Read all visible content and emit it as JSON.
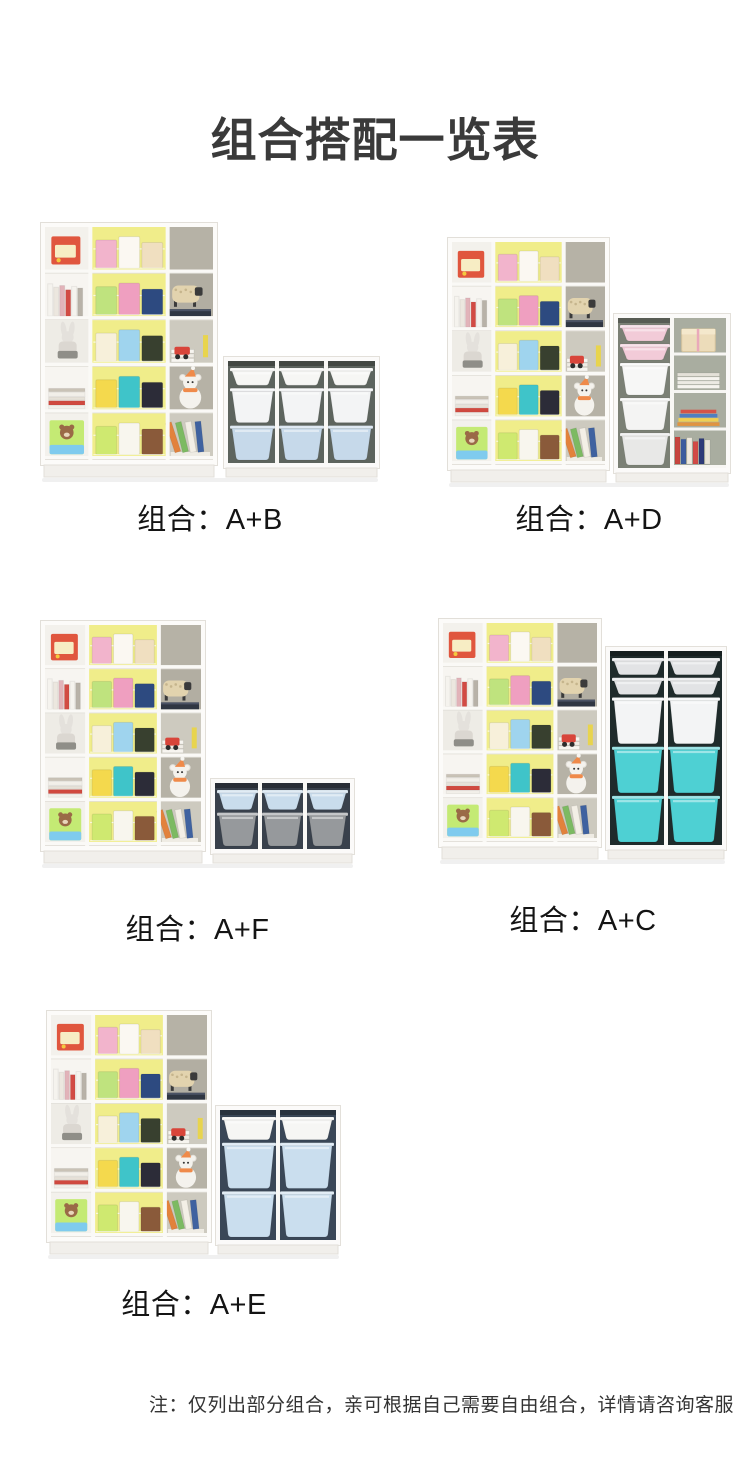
{
  "title": "组合搭配一览表",
  "footnote": "注：仅列出部分组合，亲可根据自己需要自由组合，详情请咨询客服",
  "shelf_a": {
    "frame_color": "#fcfbf9",
    "yellow_back": "#f0ed8a",
    "gray_back": "#b6b2a6"
  },
  "combos": [
    {
      "label": "组合：A+B",
      "illustration": {
        "svg_w": 340,
        "svg_h": 262,
        "shelf": {
          "w": 178,
          "h": 256
        },
        "unit": {
          "x": 183,
          "w": 157,
          "h": 122,
          "cols": 3,
          "interior": "#5d645e",
          "stack": [
            [
              "#f6f6f4",
              1
            ],
            [
              "#f3f4f5",
              2
            ],
            [
              "#c6d9ea",
              2
            ]
          ]
        }
      }
    },
    {
      "label": "组合：A+D",
      "illustration": {
        "svg_w": 284,
        "svg_h": 252,
        "shelf": {
          "w": 163,
          "h": 246
        },
        "unit": {
          "x": 166,
          "w": 118,
          "h": 170,
          "cols": 2,
          "interior": "#7b8075",
          "rightShelves": true,
          "stack": [
            [
              "#f2cbd8",
              1
            ],
            [
              "#f2cbd8",
              1
            ],
            [
              "#f7f7f6",
              2
            ],
            [
              "#f4f4f3",
              2
            ],
            [
              "#e8e8e7",
              2
            ]
          ]
        }
      }
    },
    {
      "label": "组合：A+F",
      "illustration": {
        "svg_w": 315,
        "svg_h": 250,
        "shelf": {
          "w": 166,
          "h": 244
        },
        "unit": {
          "x": 170,
          "w": 145,
          "h": 86,
          "cols": 3,
          "interior": "#39414c",
          "stack": [
            [
              "#c9dcec",
              1
            ],
            [
              "#96999c",
              1.7
            ]
          ]
        }
      }
    },
    {
      "label": "组合：A+C",
      "illustration": {
        "svg_w": 290,
        "svg_h": 248,
        "shelf": {
          "w": 164,
          "h": 242
        },
        "unit": {
          "x": 167,
          "w": 122,
          "h": 214,
          "cols": 2,
          "interior": "#1f2b2b",
          "stack": [
            [
              "#e2e3e5",
              0.8
            ],
            [
              "#e2e3e5",
              0.8
            ],
            [
              "#f3f4f5",
              2.2
            ],
            [
              "#4ed0d3",
              2.2
            ],
            [
              "#4ed0d3",
              2.2
            ]
          ]
        }
      }
    },
    {
      "label": "组合：A+E",
      "illustration": {
        "svg_w": 296,
        "svg_h": 251,
        "shelf": {
          "w": 166,
          "h": 245
        },
        "unit": {
          "x": 169,
          "w": 126,
          "h": 150,
          "cols": 2,
          "interior": "#3a4757",
          "stack": [
            [
              "#f6f6f4",
              1
            ],
            [
              "#cadeee",
              2
            ],
            [
              "#cadeee",
              2
            ]
          ]
        }
      }
    }
  ]
}
